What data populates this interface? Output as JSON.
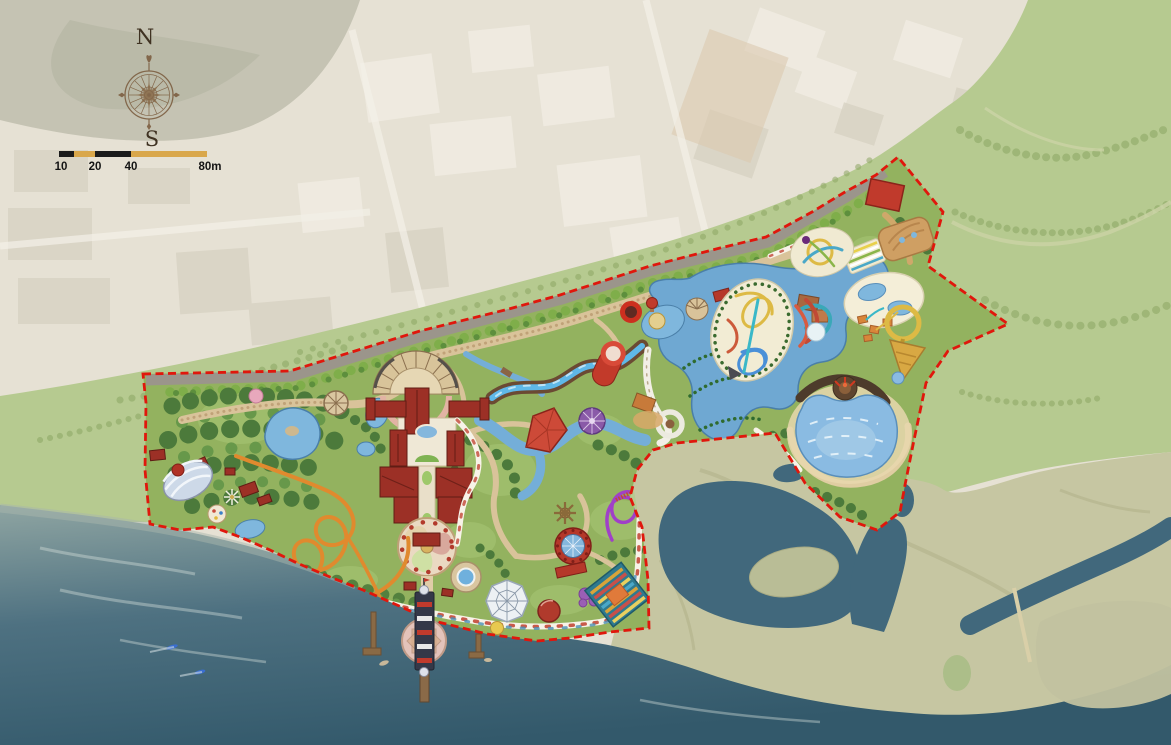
{
  "map": {
    "compass": {
      "north_label": "N",
      "south_label": "S"
    },
    "scale_bar": {
      "tick_labels": [
        "10",
        "20",
        "40",
        "80m"
      ]
    },
    "colors": {
      "industrial": "#e6e1d4",
      "woodland": "#b4b4a2",
      "field_green": "#b6ca90",
      "tidal_flat": "#c6c6a2",
      "sea_shallow": "#8fa5a2",
      "sea_mid": "#4e7181",
      "sea_deep": "#33596b",
      "estuary": "#41687c",
      "sandbar": "#b9bd96",
      "park_green": "#93b25f",
      "forest_green": "#4c7a3b",
      "canopy_light": "#a9c878",
      "road_gray": "#9b958b",
      "path_tan": "#d9c39a",
      "promenade_white": "#f7f3e8",
      "boundary_red": "#e0170c",
      "pond_blue": "#7fb7dd",
      "wave_pool_blue": "#8abbe2",
      "roof_red": "#9c3026",
      "bright_red": "#c03a2c",
      "coaster_orange": "#e08a2e",
      "coaster_purple": "#a040c8",
      "slide_yellow": "#ddba45",
      "slide_teal": "#3aa8b8",
      "funnel_gold": "#d8a843",
      "sand": "#e8d7ae",
      "compass_brown": "#7d5f41",
      "scale_black": "#1b1b1b",
      "scale_tan": "#d9a74b"
    },
    "features": [
      "compass-rose",
      "scale-bar",
      "park-boundary",
      "access-road",
      "tree-row",
      "main-building-complex",
      "entry-fan-plaza",
      "central-flower-plaza",
      "pier",
      "observation-tower-ride",
      "boat-dock",
      "beach-promenade",
      "orange-roller-coaster",
      "purple-kiddie-coaster",
      "carousel",
      "dome-pavilion",
      "rapids-river",
      "log-flume-ride",
      "lazy-river",
      "water-slide-complex",
      "racing-slides",
      "funnel-slide",
      "kids-splash-area",
      "wave-pool",
      "volcano-feature",
      "amphitheater-dome",
      "spider-web-pavilion",
      "striped-flower-beds",
      "hedge-maze",
      "forest-grove",
      "pond",
      "sea",
      "estuary-channel",
      "sandbar-island",
      "tidal-flat",
      "green-field",
      "industrial-district"
    ]
  }
}
